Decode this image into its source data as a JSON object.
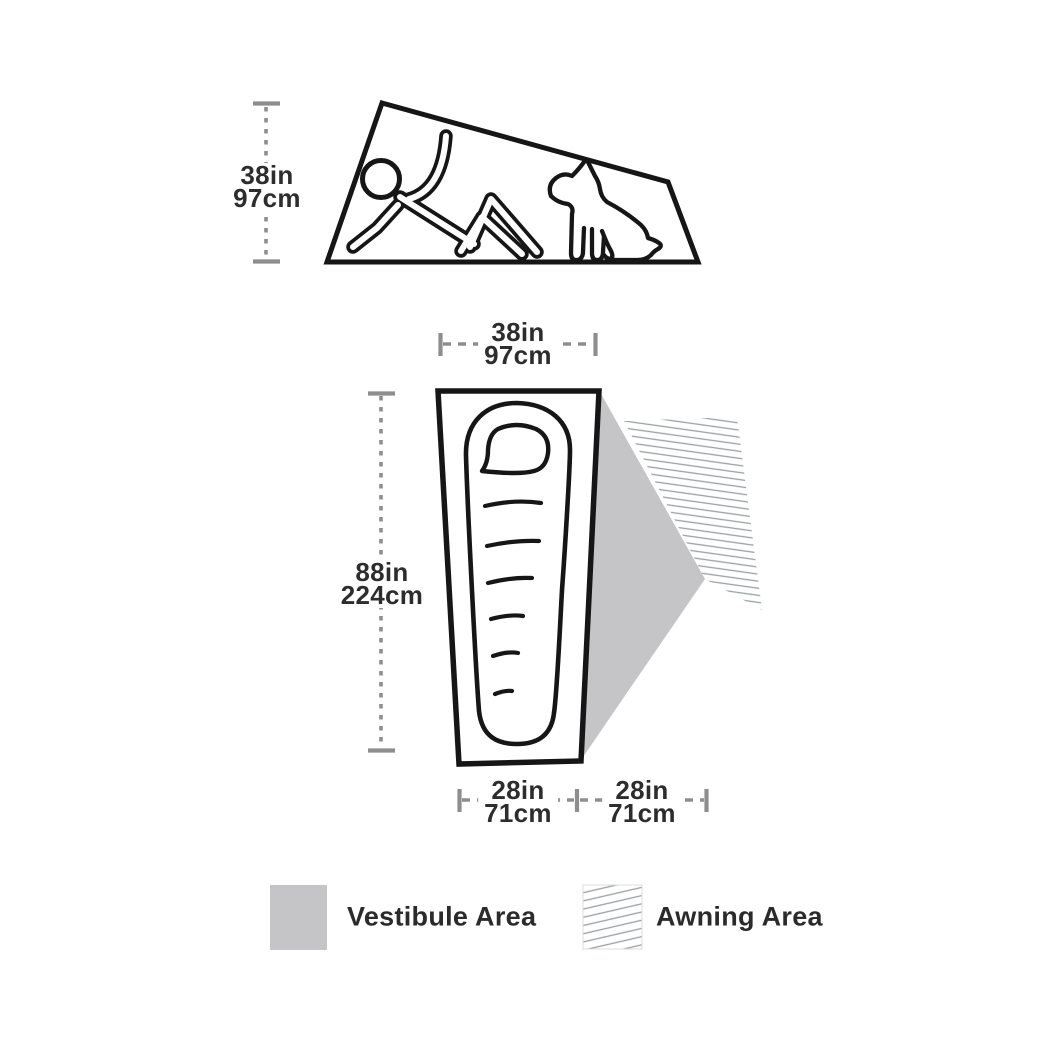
{
  "side_view": {
    "height_label": {
      "imperial": "38in",
      "metric": "97cm"
    }
  },
  "top_view": {
    "width_label": {
      "imperial": "38in",
      "metric": "97cm"
    },
    "length_label": {
      "imperial": "88in",
      "metric": "224cm"
    },
    "floor_width_label": {
      "imperial": "28in",
      "metric": "71cm"
    },
    "vestibule_width_label": {
      "imperial": "28in",
      "metric": "71cm"
    }
  },
  "legend": [
    {
      "label": "Vestibule Area",
      "swatch": "solid"
    },
    {
      "label": "Awning Area",
      "swatch": "hatched"
    }
  ],
  "colors": {
    "line_art": "#161616",
    "dimension_gray": "#8e8e90",
    "label_text": "#2d2d2d",
    "vestibule_fill": "#c5c5c8",
    "hatch_line": "#9aa0a3",
    "background": "#ffffff"
  }
}
